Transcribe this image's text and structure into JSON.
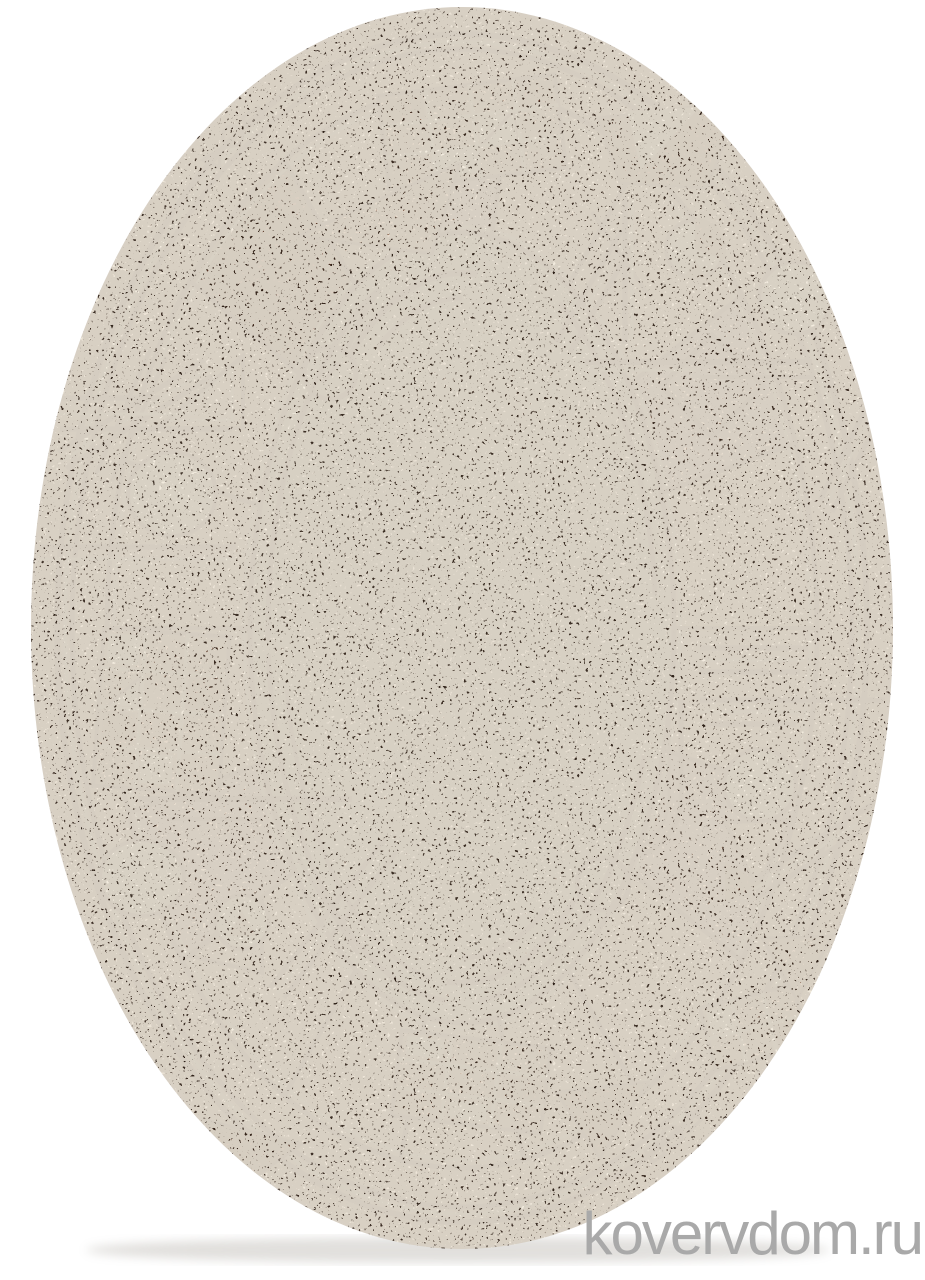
{
  "page": {
    "background_color": "#ffffff"
  },
  "watermark": {
    "text": "kovervdom.ru",
    "color": "#a9a9a9"
  },
  "rug": {
    "shape": "oval",
    "description": "beige-brown speckled pile rug with abstract geometric border: triangles, circles, brick grids, stick lines",
    "colors": {
      "field": "#b1a193",
      "outer_ring": "#b5a697",
      "mid_ring": "#c6b7a8",
      "band_light": "#cbbcad",
      "band_mid_brown": "#9b7b67",
      "band_dark_brown": "#5a3424",
      "outline_black": "#211711",
      "accent_white": "#eae3d7",
      "binding": "#d8ccbe"
    }
  }
}
